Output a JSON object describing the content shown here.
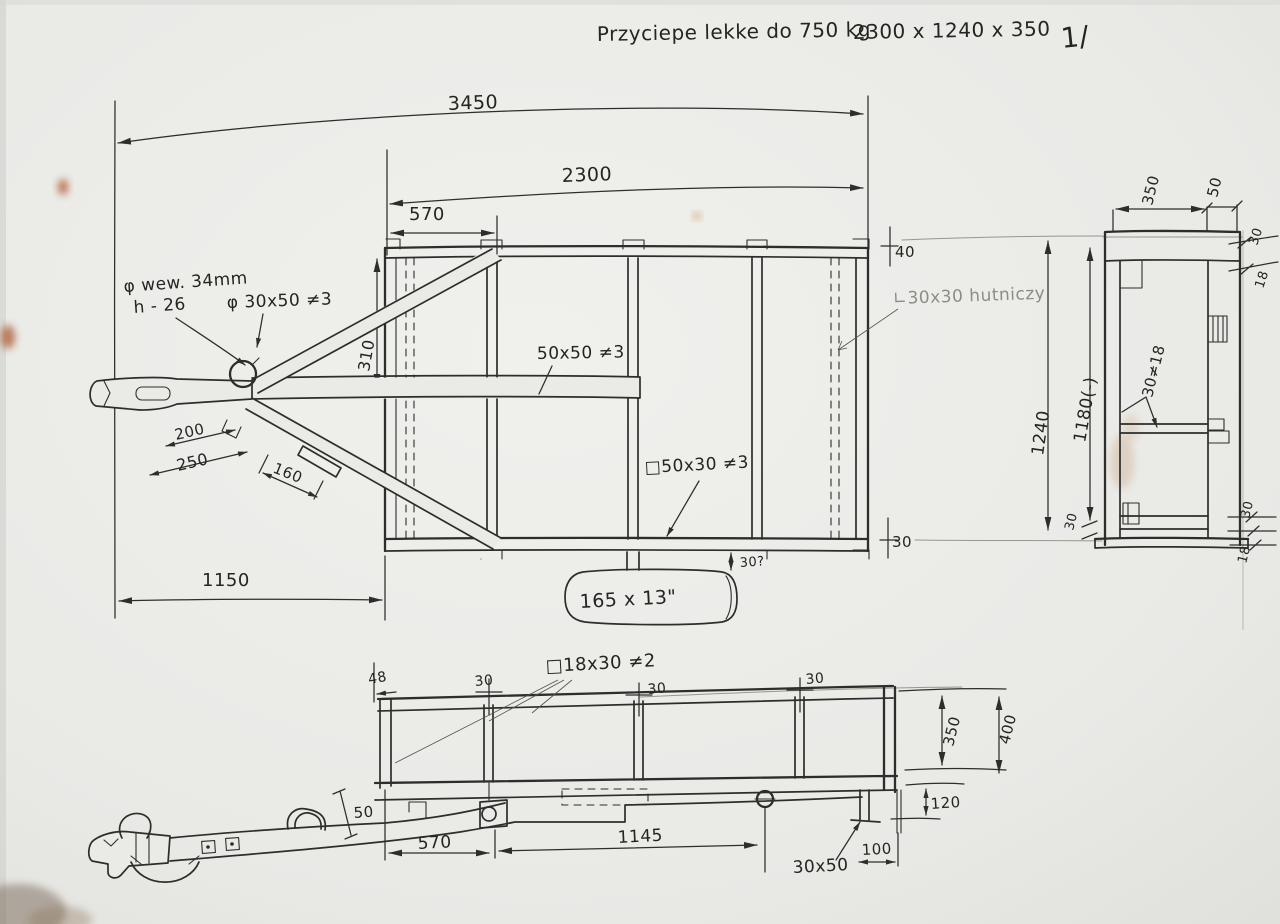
{
  "header": {
    "title": "Przyciepe lekke do 750 kg",
    "dimensions": "2300 x 1240 x 350",
    "page": "1/"
  },
  "plan": {
    "dim_overall": "3450",
    "dim_bed": "2300",
    "dim_front": "570",
    "dim_310": "310",
    "dim_drawbar": "1150",
    "dim_width": "1240",
    "dim_inner_width": "1180(-)",
    "dim_width_edge": "30",
    "dim_front_rail": "40",
    "dim_rear_rail": "30",
    "dim_hitch_200": "200",
    "dim_hitch_250": "250",
    "dim_hitch_160": "160",
    "label_hub_dia": "φ wew. 34mm",
    "label_hub_h": "h - 26",
    "label_drawbar_profile": "φ 30x50 ≠3",
    "label_center_beam": "50x50 ≠3",
    "label_cross_member": "□50x30 ≠3",
    "label_corner_angle": "∟30x30 hutniczy",
    "label_tyre": "165 x 13\"",
    "dim_tyre_gap": "30?"
  },
  "rear": {
    "dim_350": "350",
    "dim_50": "50",
    "dim_top_30": "30",
    "dim_top_18": "18",
    "label_30_18": "30≠18",
    "dim_bottom_30": "30",
    "dim_bottom_18": "18"
  },
  "side": {
    "dim_48": "48",
    "dim_post1_30": "30",
    "dim_post2_30": "30",
    "dim_post3_30": "30",
    "label_top_rail": "□18x30 ≠2",
    "dim_drawbar_50": "50",
    "dim_570": "570",
    "dim_1145": "1145",
    "dim_100": "100",
    "label_rear_bracket": "30x50",
    "dim_350": "350",
    "dim_400": "400",
    "dim_120": "120"
  }
}
